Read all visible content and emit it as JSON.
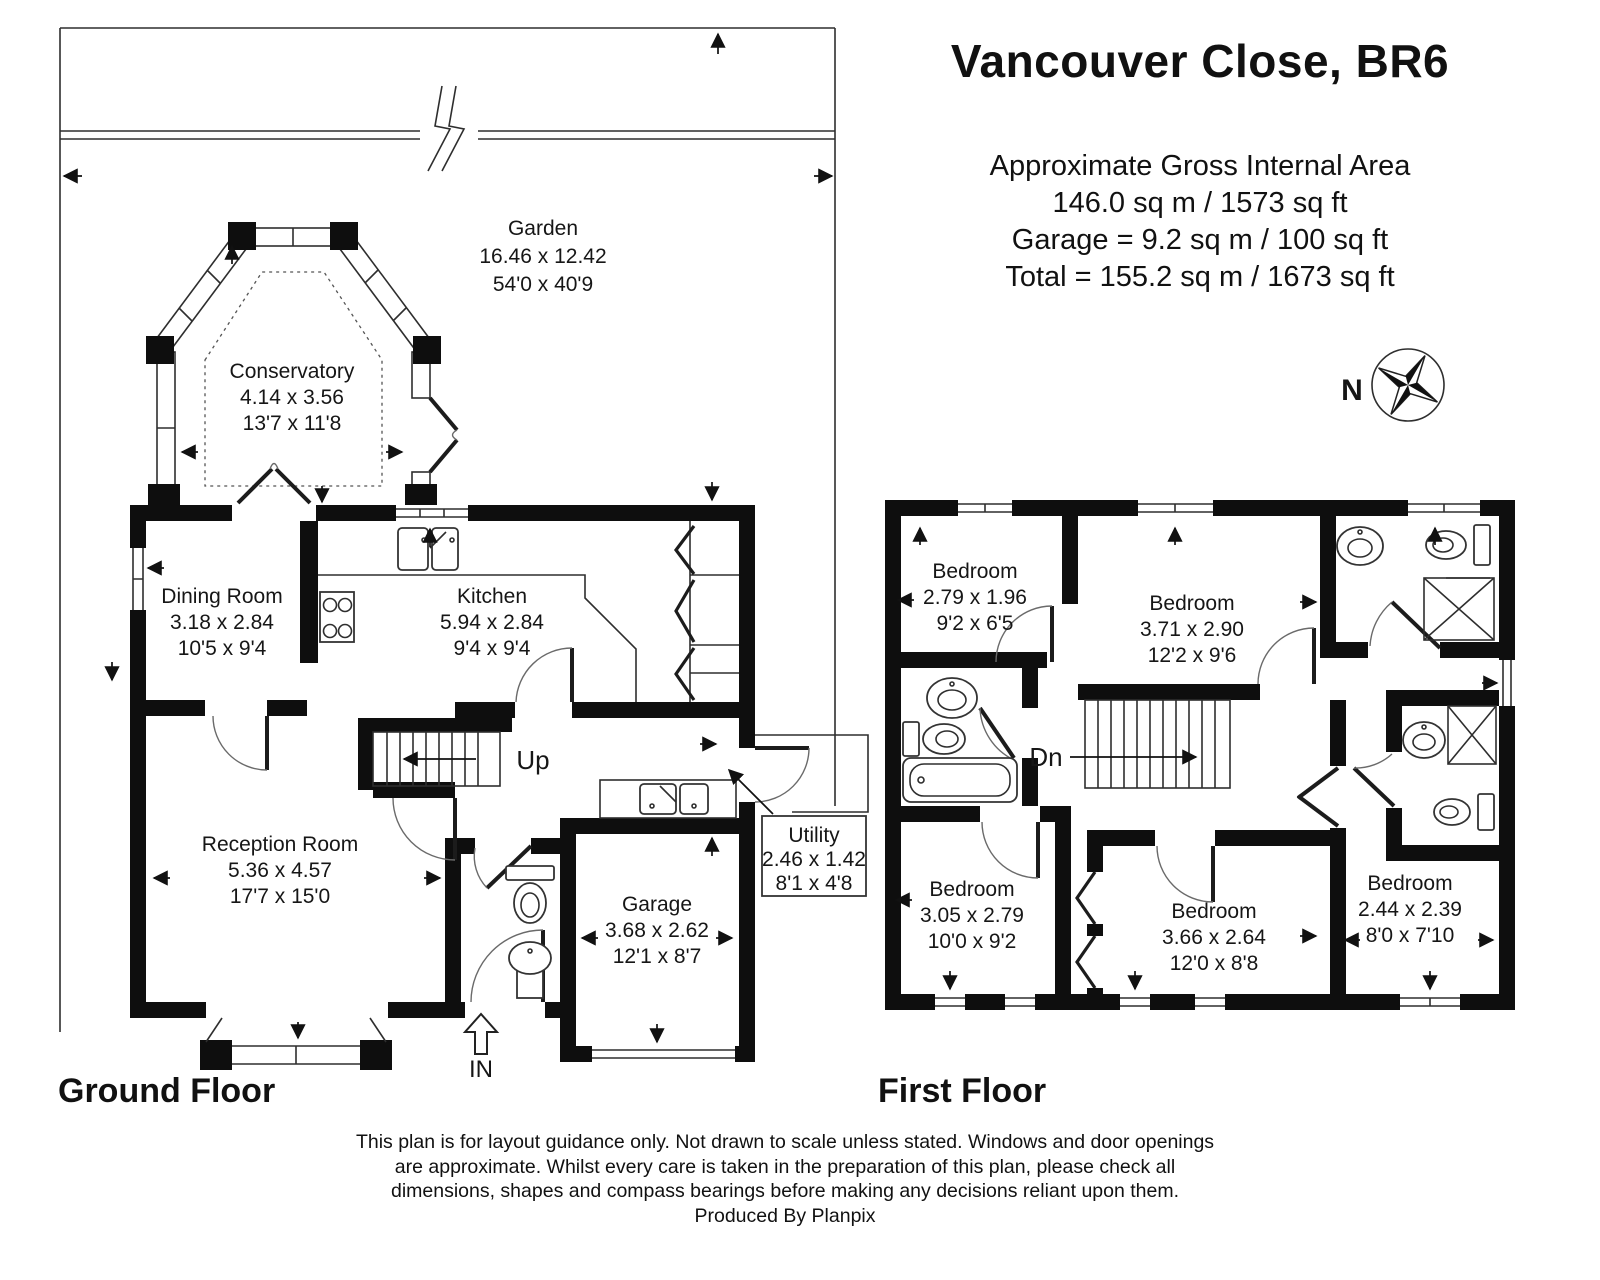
{
  "title_block": {
    "title": "Vancouver Close, BR6",
    "heading": "Approximate Gross Internal Area",
    "lines": [
      "146.0 sq m / 1573 sq ft",
      "Garage = 9.2 sq m / 100 sq ft",
      "Total = 155.2 sq m / 1673 sq ft"
    ]
  },
  "compass": {
    "north_label": "N"
  },
  "garden": {
    "name": "Garden",
    "metric": "16.46 x 12.42",
    "imperial": "54'0 x 40'9"
  },
  "ground_floor": {
    "label": "Ground Floor",
    "stairs_label": "Up",
    "entrance_label": "IN",
    "rooms": {
      "conservatory": {
        "name": "Conservatory",
        "metric": "4.14 x 3.56",
        "imperial": "13'7 x 11'8"
      },
      "dining": {
        "name": "Dining Room",
        "metric": "3.18 x 2.84",
        "imperial": "10'5 x 9'4"
      },
      "kitchen": {
        "name": "Kitchen",
        "metric": "5.94 x 2.84",
        "imperial": "9'4 x 9'4"
      },
      "reception": {
        "name": "Reception Room",
        "metric": "5.36 x 4.57",
        "imperial": "17'7 x 15'0"
      },
      "garage": {
        "name": "Garage",
        "metric": "3.68 x 2.62",
        "imperial": "12'1 x 8'7"
      },
      "utility": {
        "name": "Utility",
        "metric": "2.46 x 1.42",
        "imperial": "8'1 x 4'8"
      }
    }
  },
  "first_floor": {
    "label": "First Floor",
    "stairs_label": "Dn",
    "rooms": {
      "bedroom1": {
        "name": "Bedroom",
        "metric": "2.79 x 1.96",
        "imperial": "9'2 x 6'5"
      },
      "bedroom2": {
        "name": "Bedroom",
        "metric": "3.71 x 2.90",
        "imperial": "12'2 x 9'6"
      },
      "bedroom3": {
        "name": "Bedroom",
        "metric": "3.05 x 2.79",
        "imperial": "10'0 x 9'2"
      },
      "bedroom4": {
        "name": "Bedroom",
        "metric": "3.66 x 2.64",
        "imperial": "12'0 x 8'8"
      },
      "bedroom5": {
        "name": "Bedroom",
        "metric": "2.44 x 2.39",
        "imperial": "8'0 x 7'10"
      }
    }
  },
  "footer": {
    "disclaimer_lines": [
      "This plan is for layout guidance only. Not drawn to scale unless stated. Windows and door openings",
      "are approximate. Whilst every care is taken in the preparation of this plan, please check all",
      "dimensions, shapes and compass bearings before making any decisions reliant upon them."
    ],
    "credit": "Produced By Planpix"
  }
}
